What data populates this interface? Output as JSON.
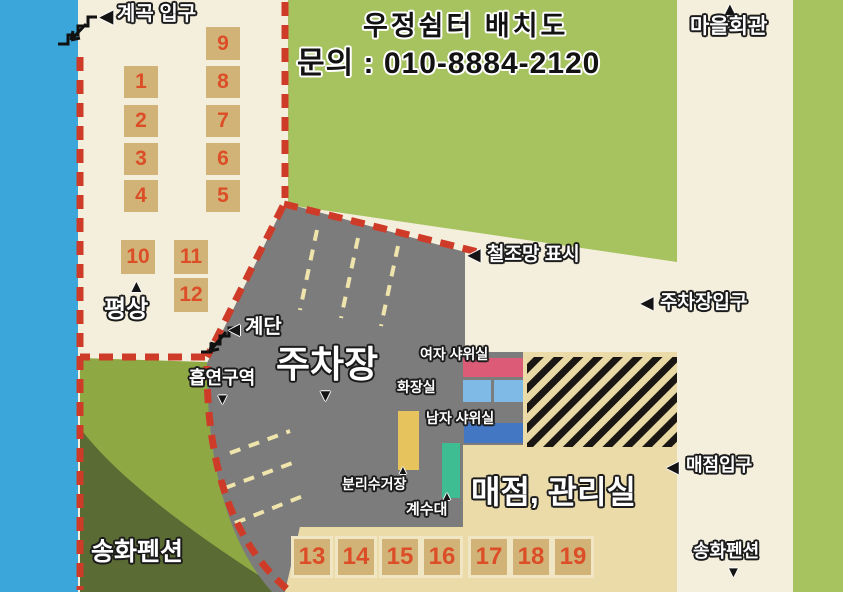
{
  "title": "우정쉼터 배치도",
  "contact": "문의 : 010-8884-2120",
  "labels": {
    "valley_entrance": "계곡 입구",
    "village_hall": "마을회관",
    "fence_mark": "철조망 표시",
    "parking_lot_entrance": "주차장입구",
    "bench": "평상",
    "stairs": "계단",
    "smoking_area": "흡연구역",
    "parking_lot": "주차장",
    "women_shower": "여자 샤위실",
    "restroom": "화장실",
    "men_shower": "남자 샤위실",
    "recycling_station": "분리수거장",
    "sink": "계수대",
    "store_office": "매점, 관리실",
    "store_entrance": "매점입구",
    "pension_southwest": "송화펜션",
    "pension_southeast": "송화펜션"
  },
  "arrows": {
    "left": "◀",
    "up": "▲",
    "down": "▼"
  },
  "sites": [
    "1",
    "2",
    "3",
    "4",
    "5",
    "6",
    "7",
    "8",
    "9",
    "10",
    "11",
    "12",
    "13",
    "14",
    "15",
    "16",
    "17",
    "18",
    "19"
  ],
  "colors": {
    "water": "#3AA6D9",
    "field_green": "#A7C35F",
    "pension_dark_green": "#5A6B33",
    "pension_light_green": "#8EA844",
    "parking_gray": "#7C7C7C",
    "store_tan": "#EADBA9",
    "boundary_red": "#CE3C29",
    "lane_yellow": "#EFE5AC",
    "site_box": "#D2B377",
    "site_number": "#DB4E28",
    "women_shower_building": "#DC5C78",
    "restroom_building": "#7FB9E6",
    "men_shower_building": "#4377C4",
    "recycling_building": "#E6C35C",
    "sink_building": "#3FBD92"
  }
}
